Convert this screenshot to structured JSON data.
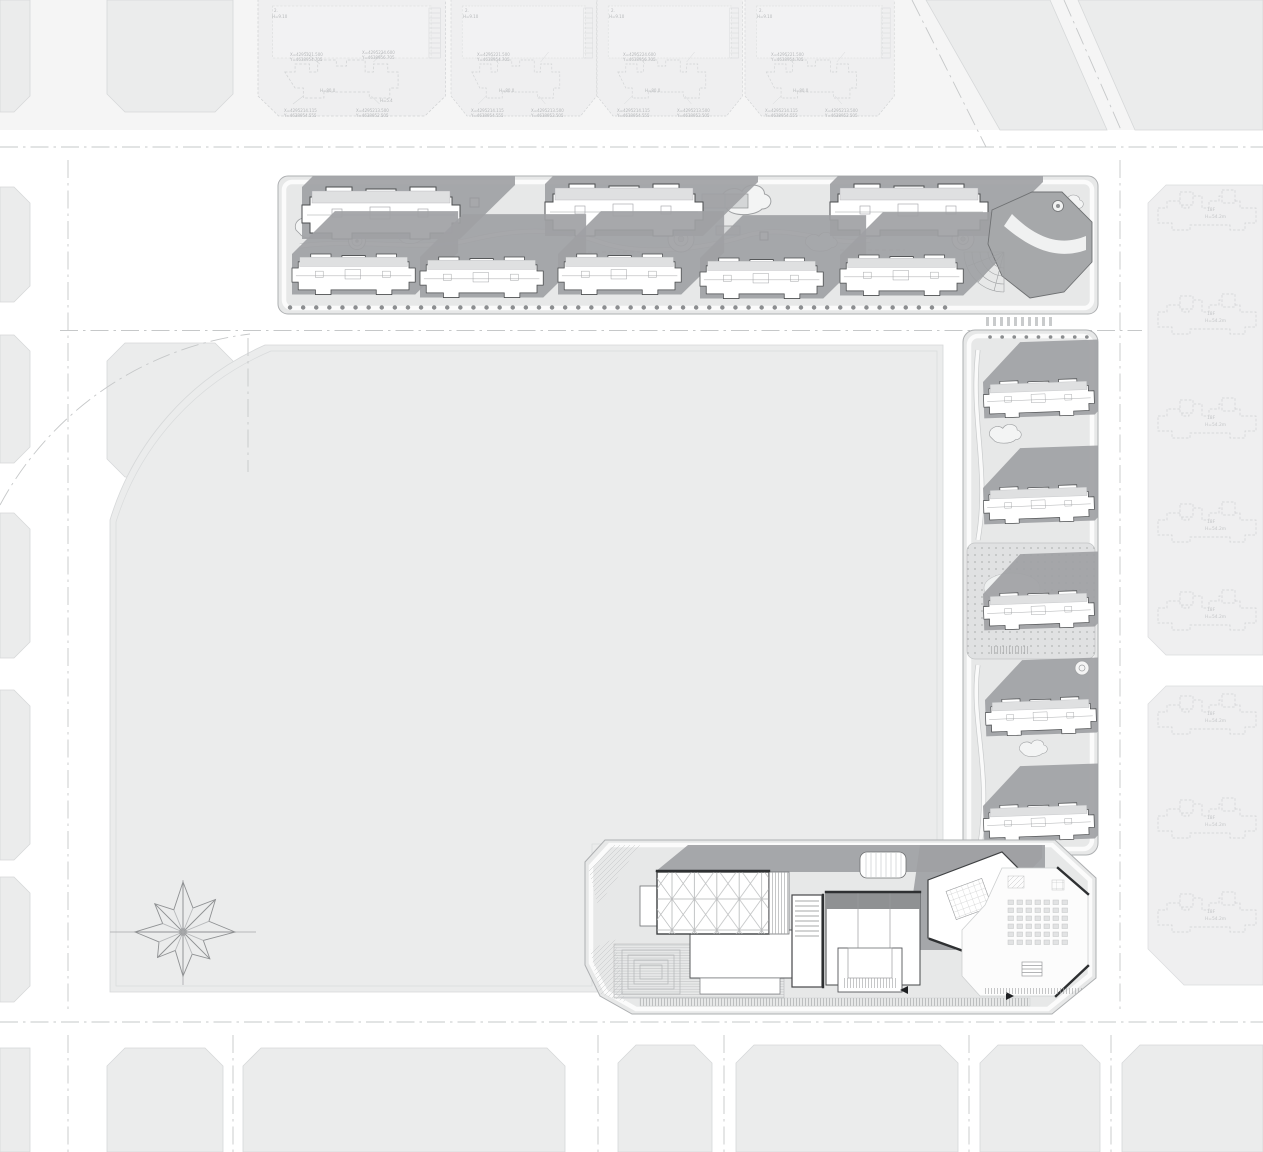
{
  "drawing": {
    "title": "Residential district master site plan",
    "type": "architectural-site-plan"
  },
  "colors": {
    "road": "#ffffff",
    "parcel": "#ebecec",
    "site_base": "#e7e8e8",
    "building_fill": "#ffffff",
    "building_shadow": "#9fa1a4",
    "dark_edge": "#2e3032",
    "faded_context": "#cfd1d2"
  },
  "annotations": {
    "north_blocks": {
      "storeys": "2.",
      "eave_height": "H=9.10",
      "building_height": "H=80.0",
      "minor_height": "H=5.4",
      "coord_top_x": "X=4295221.500",
      "coord_top_y": "Y=4638954.705",
      "coord_top2_x": "X=4295224.600",
      "coord_top2_y": "Y=4638956.705",
      "coord_bottom_x": "X=4295214.115",
      "coord_bottom_y": "Y=4638954.555",
      "coord_bottom2_x": "X=4295213.500",
      "coord_bottom2_y": "Y=4638952.505"
    },
    "east_buildings": {
      "floors": "18F",
      "height": "H=54.2m"
    }
  },
  "inventory": {
    "north_strip": {
      "top_row_buildings": 3,
      "bottom_row_buildings": 5,
      "corner_buildings": 1
    },
    "east_strip_buildings": 5,
    "south_complex_buildings": 1,
    "adjacent_north_blocks": 4,
    "adjacent_east_buildings": 8
  }
}
